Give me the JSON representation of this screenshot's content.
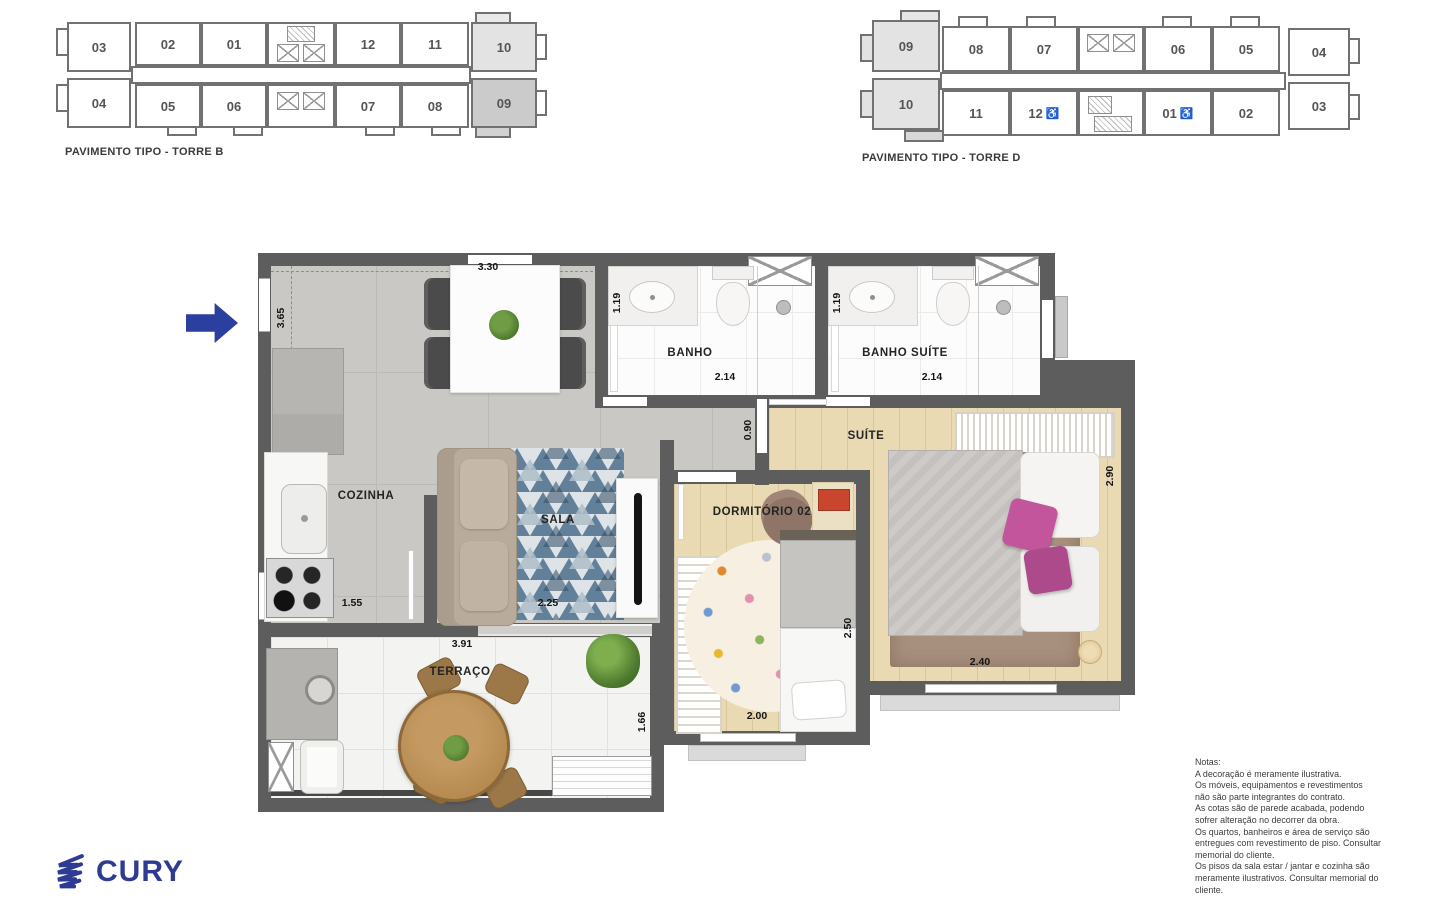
{
  "torre_b": {
    "caption": "PAVIMENTO TIPO - TORRE B",
    "left_top": "03",
    "left_bottom": "04",
    "top_row": [
      "02",
      "01",
      "12",
      "11"
    ],
    "bottom_row": [
      "05",
      "06",
      "07",
      "08"
    ],
    "right_top": "10",
    "right_bottom": "09"
  },
  "torre_d": {
    "caption": "PAVIMENTO TIPO - TORRE D",
    "left_top": "09",
    "left_bottom": "10",
    "top_row": [
      "08",
      "07",
      "06",
      "05"
    ],
    "bottom_row": [
      "11",
      "12",
      "01",
      "02"
    ],
    "right_top": "04",
    "right_bottom": "03"
  },
  "icons": {
    "wheelchair": "♿"
  },
  "plan": {
    "rooms": {
      "cozinha": "COZINHA",
      "sala": "SALA",
      "terraco": "TERRAÇO",
      "banho": "BANHO",
      "banho_suite": "BANHO SUÍTE",
      "suite": "SUÍTE",
      "dormitorio_02": "DORMITÓRIO 02"
    },
    "dims": {
      "top_width": "3.30",
      "left_height": "3.65",
      "banho_depth": "1.19",
      "banho_width": "2.14",
      "banho_suite_depth": "1.19",
      "banho_suite_width": "2.14",
      "hall_width": "0.90",
      "suite_height": "2.90",
      "suite_width": "2.40",
      "cozinha_width": "1.55",
      "sala_width": "2.25",
      "terraco_width": "3.91",
      "terraco_height": "1.66",
      "dorm_width": "2.00",
      "dorm_height": "2.50"
    }
  },
  "notes": {
    "title": "Notas:",
    "lines": [
      "A decoração é meramente ilustrativa.",
      "Os móveis, equipamentos e revestimentos",
      "não são parte integrantes do contrato.",
      "As cotas são de parede acabada, podendo",
      "sofrer alteração no decorrer da obra.",
      "Os quartos, banheiros e área de serviço são",
      "entregues com revestimento de piso. Consultar",
      "memorial do cliente.",
      "Os pisos da sala estar / jantar e cozinha são",
      "meramente ilustrativos. Consultar memorial do",
      "cliente."
    ]
  },
  "logo": {
    "text": "CURY"
  },
  "colors": {
    "wall": "#5e5d5d",
    "arrow_blue": "#2b3f9e",
    "logo_blue": "#2e3b93",
    "highlight_unit_light": "#e3e3e3",
    "highlight_unit_dark": "#cbcbcb"
  }
}
